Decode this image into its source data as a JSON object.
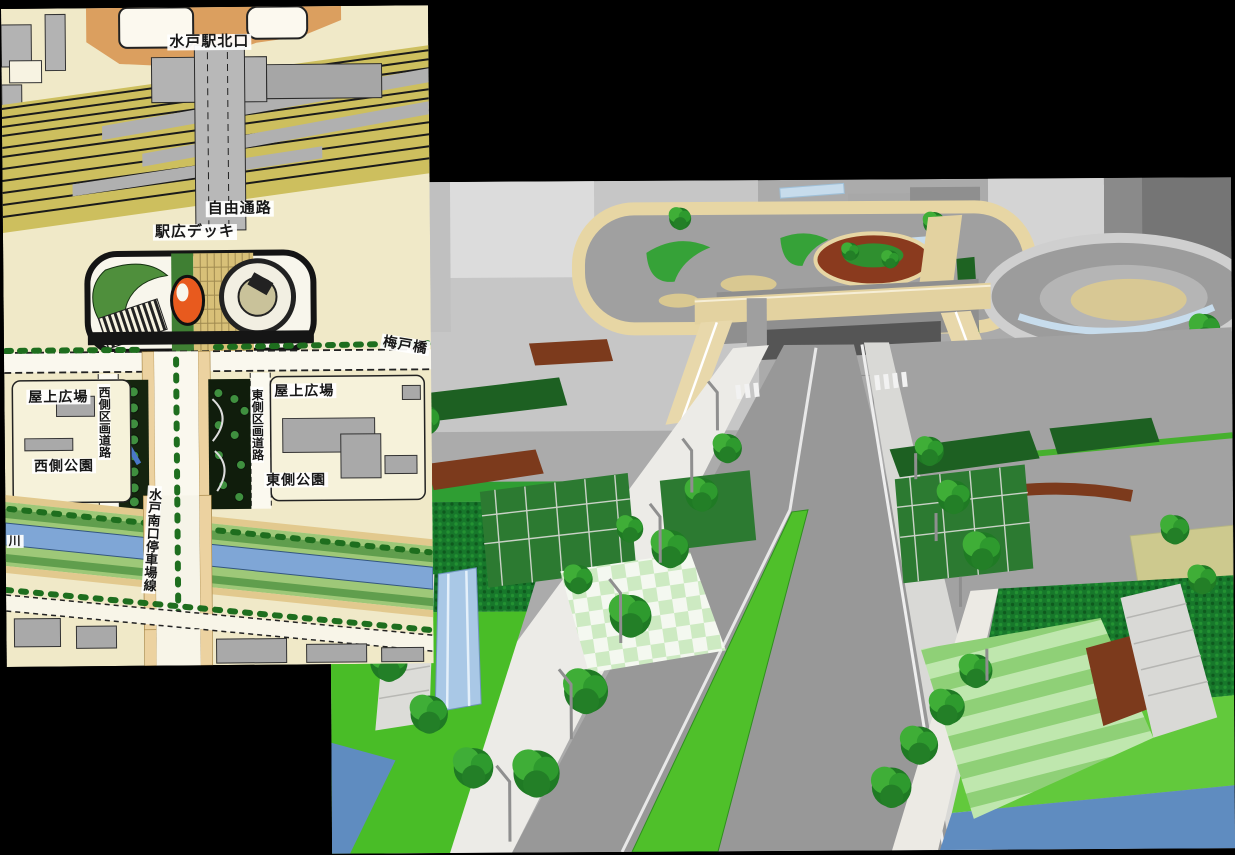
{
  "page": {
    "title": "Mito Station south plaza — site plan map and 3D CG rendering collage",
    "background_color": "#000000"
  },
  "map": {
    "type": "site-plan",
    "labels": {
      "north_exit": "水戸駅北口",
      "free_passage": "自由通路",
      "station_deck": "駅広デッキ",
      "umedo_bridge": "梅戸橋",
      "rooftop_plaza_left": "屋上広場",
      "rooftop_plaza_right": "屋上広場",
      "west_district_road": "西側区画道路",
      "east_district_road": "東側区画道路",
      "west_park": "西側公園",
      "east_park": "東側公園",
      "station_front_road": "水戸南口停車場線",
      "river_partial": "川"
    },
    "colors": {
      "paper": "#f0e9c8",
      "rail_yard": "#cdbf5e",
      "building_gray": "#ababab",
      "road_white": "#faf8ee",
      "sidewalk_tan": "#ecd2a0",
      "park_green": "#4f8f3c",
      "river_blue": "#7fa6d6",
      "deck_monument_red": "#e85a1e",
      "station_area_tan": "#db9f5f"
    }
  },
  "render3d": {
    "type": "cg-perspective-rendering",
    "subject": "aerial view of station south exit plaza, pedestrian deck, boulevard and riverside fields",
    "colors": {
      "ground_gray": "#ababab",
      "deck_beige": "#e3d2a0",
      "tree_green": "#2e8f2e",
      "lawn_green": "#49bd27",
      "field_green": "#17782b",
      "river_blue": "#5f8cc0",
      "path_brown": "#7c3a1c",
      "canopy_blue": "#c7dcec",
      "hedge_green": "#1d6022"
    }
  }
}
